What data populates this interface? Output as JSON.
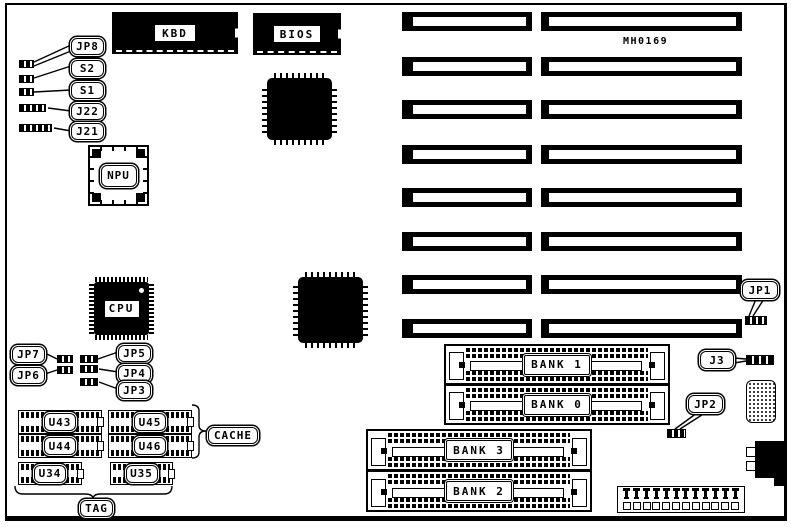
{
  "part_number": "MH0169",
  "chips": {
    "kbd": "KBD",
    "bios": "BIOS",
    "npu": "NPU",
    "cpu": "CPU"
  },
  "jumpers": {
    "jp8": "JP8",
    "s2": "S2",
    "s1": "S1",
    "j22": "J22",
    "j21": "J21",
    "jp7": "JP7",
    "jp6": "JP6",
    "jp5": "JP5",
    "jp4": "JP4",
    "jp3": "JP3",
    "jp1": "JP1",
    "j3": "J3",
    "jp2": "JP2"
  },
  "cache": {
    "chips": {
      "u43": "U43",
      "u44": "U44",
      "u34": "U34",
      "u45": "U45",
      "u46": "U46",
      "u35": "U35"
    },
    "group_label": "CACHE",
    "tag_label": "TAG"
  },
  "memory": {
    "banks": {
      "bank1": "BANK 1",
      "bank0": "BANK 0",
      "bank3": "BANK 3",
      "bank2": "BANK 2"
    }
  },
  "colors": {
    "ink": "#000000",
    "background": "#ffffff"
  }
}
